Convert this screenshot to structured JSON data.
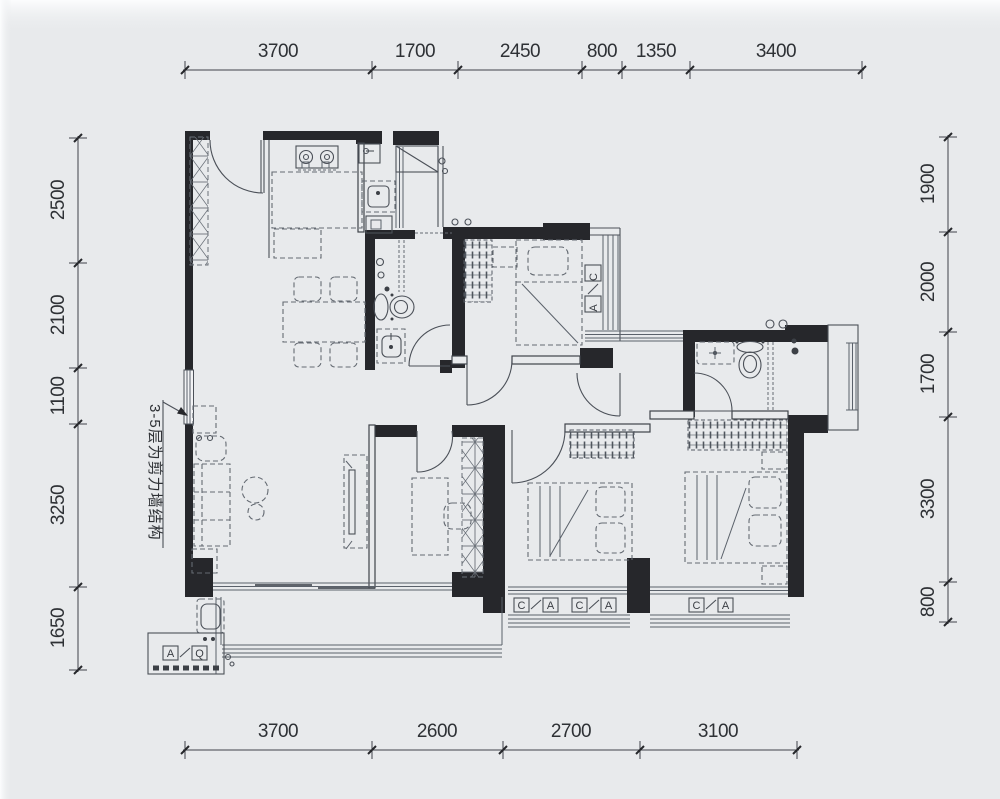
{
  "colors": {
    "background": "#e8eaec",
    "wall": "#26272b",
    "line": "#4b5058",
    "dim_text": "#2e3135"
  },
  "dimensions": {
    "top": [
      "3700",
      "1700",
      "2450",
      "800",
      "1350",
      "3400"
    ],
    "bottom": [
      "3700",
      "2600",
      "2700",
      "3100"
    ],
    "left": [
      "2500",
      "2100",
      "1100",
      "3250",
      "1650"
    ],
    "right": [
      "1900",
      "2000",
      "1700",
      "3300",
      "800"
    ]
  },
  "annotation": {
    "structural_note": "3-5层为剪力墙结构"
  },
  "tags": {
    "window": {
      "first": "C",
      "second": "A"
    },
    "balcony": {
      "first": "A",
      "second": "Q"
    }
  }
}
